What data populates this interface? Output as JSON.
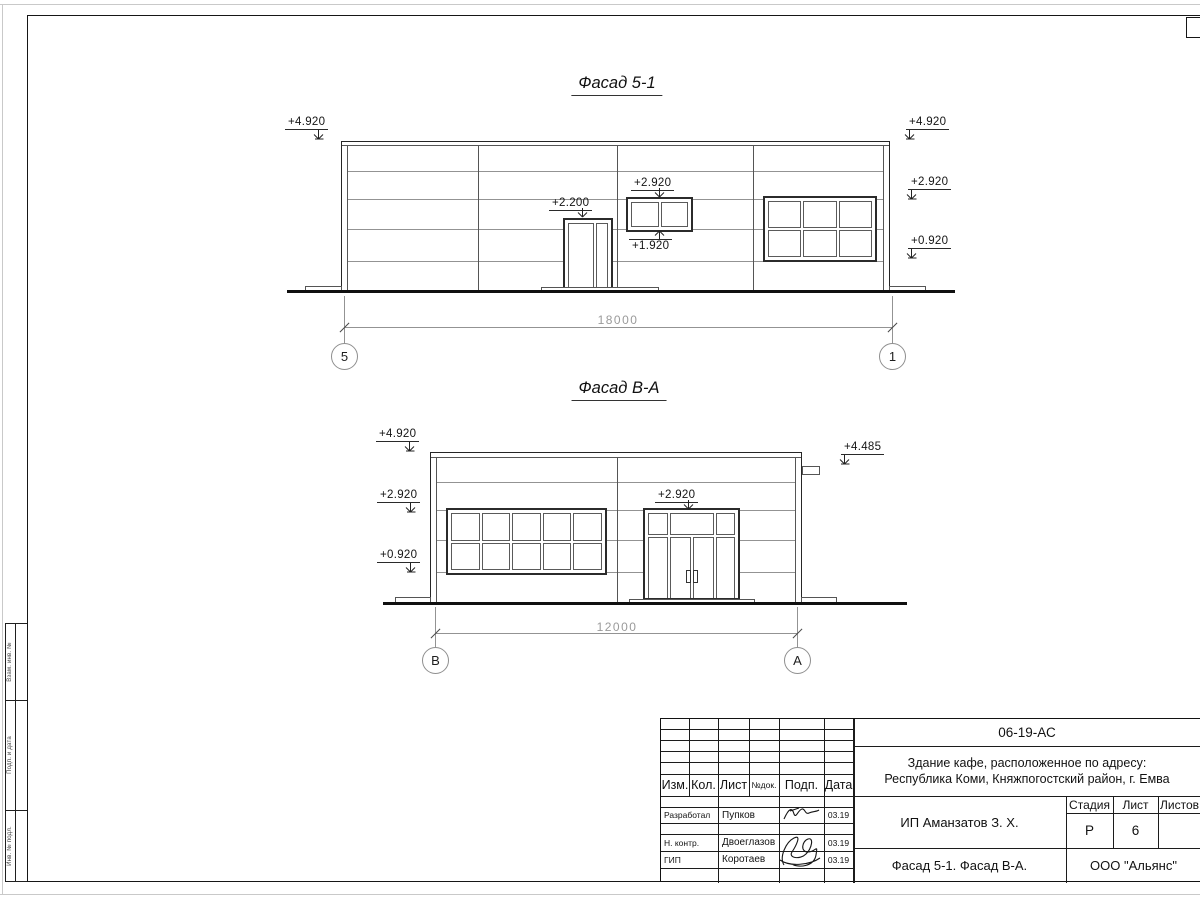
{
  "sheet": {
    "facade1": {
      "title": "Фасад 5-1",
      "dimension": "18000",
      "axis_left": "5",
      "axis_right": "1",
      "marks": {
        "top_left": "+4.920",
        "top_right": "+4.920",
        "right_mid": "+2.920",
        "right_low": "+0.920",
        "door": "+2.200",
        "window_top": "+2.920",
        "window_bottom": "+1.920"
      }
    },
    "facade2": {
      "title": "Фасад В-А",
      "dimension": "12000",
      "axis_left": "В",
      "axis_right": "А",
      "marks": {
        "top_left": "+4.920",
        "left_mid": "+2.920",
        "left_low": "+0.920",
        "right": "+4.485",
        "door": "+2.920"
      }
    },
    "side_column": {
      "top": "Взам. инв. №",
      "middle": "Подп. и дата",
      "bottom": "Инв. № подл."
    },
    "title_block": {
      "doc_number": "06-19-АС",
      "project_line1": "Здание кафе, расположенное по адресу:",
      "project_line2": "Республика Коми, Княжпогостский район, г. Емва",
      "client": "ИП Аманзатов З. Х.",
      "sheet_title": "Фасад 5-1. Фасад В-А.",
      "company": "ООО \"Альянс\"",
      "headers": {
        "izm": "Изм.",
        "kol": "Кол.",
        "list": "Лист",
        "ndok": "№док.",
        "podp": "Подп.",
        "data": "Дата",
        "stage": "Стадия",
        "sheet": "Лист",
        "sheets": "Листов"
      },
      "stage_value": "Р",
      "sheet_value": "6",
      "signers": [
        {
          "role": "Разработал",
          "name": "Пупков",
          "date": "03.19"
        },
        {
          "role": "Н. контр.",
          "name": "Двоеглазов",
          "date": "03.19"
        },
        {
          "role": "ГИП",
          "name": "Коротаев",
          "date": "03.19"
        }
      ]
    }
  }
}
